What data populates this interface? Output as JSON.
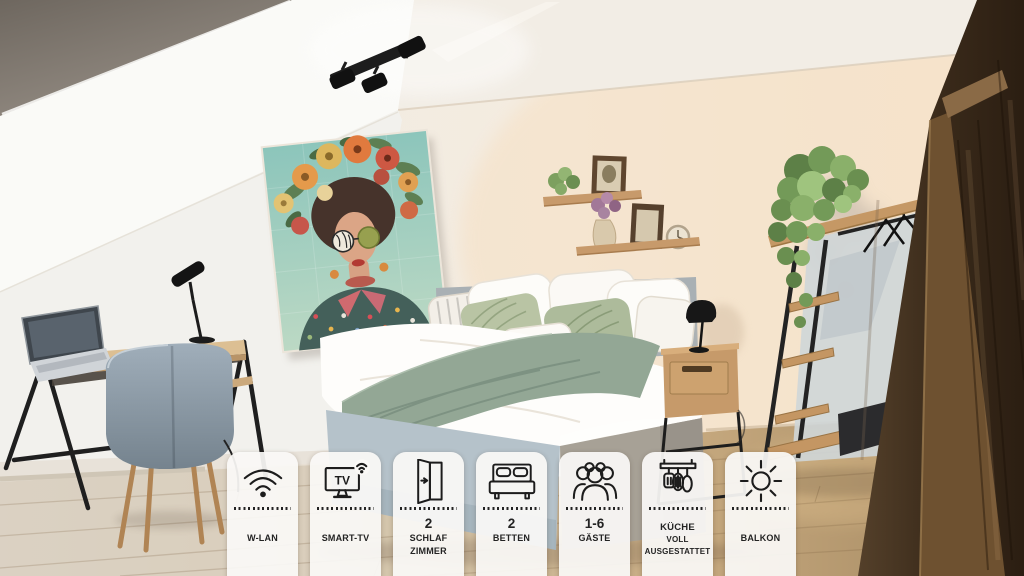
{
  "listing_overlay": {
    "badges": [
      {
        "icon": "wifi-icon",
        "value": "",
        "labels": [
          "W-LAN"
        ]
      },
      {
        "icon": "smart-tv-icon",
        "value": "",
        "labels": [
          "SMART-TV"
        ]
      },
      {
        "icon": "open-door-icon",
        "value": "2",
        "labels": [
          "SCHLAF",
          "ZIMMER"
        ]
      },
      {
        "icon": "double-bed-icon",
        "value": "2",
        "labels": [
          "BETTEN"
        ]
      },
      {
        "icon": "guests-group-icon",
        "value": "1-6",
        "labels": [
          "GÄSTE"
        ]
      },
      {
        "icon": "kitchen-utensils-icon",
        "value": "",
        "labels": [
          "KÜCHE",
          "VOLL",
          "AUSGESTATTET"
        ]
      },
      {
        "icon": "sun-icon",
        "value": "",
        "labels": [
          "BALKON"
        ]
      }
    ],
    "tv_icon_label": "TV"
  },
  "colors": {
    "badge_background": "#faf9f6",
    "badge_text": "#232323",
    "icon_stroke": "#1c1c1c",
    "wall_warm_white": "#f4ece1",
    "floor_wood_left": "#d8cfc0",
    "floor_wood_right": "#a98a64",
    "textile_green": "#93a795",
    "artwork_teal": "#8cc5bb",
    "wardrobe_brown": "#3a2a1c"
  },
  "scene": {
    "description": "Attic bedroom: double bed with green throw and leaf-print pillows, flower-crown portrait artwork, desk with laptop and grey chair, wall shelves with plants and frames, open clothes rack with trailing plant, dark wooden wardrobe, ceiling spotlights"
  }
}
